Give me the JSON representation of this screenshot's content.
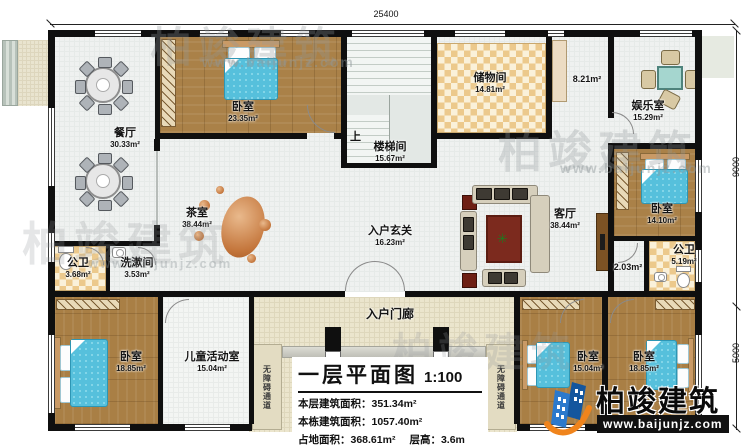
{
  "drawing": {
    "dimensions": {
      "top": "25400",
      "right_upper": "9000",
      "right_lower": "5000"
    },
    "rooms": [
      {
        "name": "餐厅",
        "area": "30.33m²"
      },
      {
        "name": "卧室",
        "area": "23.35m²"
      },
      {
        "name": "楼梯间",
        "area": "15.67m²",
        "up": "上"
      },
      {
        "name": "储物间",
        "area": "14.81m²"
      },
      {
        "name": "",
        "area": "8.21m²"
      },
      {
        "name": "娱乐室",
        "area": "15.29m²"
      },
      {
        "name": "茶室",
        "area": "38.44m²"
      },
      {
        "name": "入户玄关",
        "area": "16.23m²"
      },
      {
        "name": "客厅",
        "area": "38.44m²"
      },
      {
        "name": "卧室",
        "area": "14.10m²"
      },
      {
        "name": "公卫",
        "area": "5.19m²"
      },
      {
        "name": "",
        "area": "2.03m²"
      },
      {
        "name": "公卫",
        "area": "3.68m²"
      },
      {
        "name": "洗漱间",
        "area": "3.53m²"
      },
      {
        "name": "卧室",
        "area": "18.85m²"
      },
      {
        "name": "儿童活动室",
        "area": "15.04m²"
      },
      {
        "name": "卧室",
        "area": "15.04m²"
      },
      {
        "name": "卧室",
        "area": "18.85m²"
      },
      {
        "name": "入户门廊"
      },
      {
        "name": "无障碍通道"
      }
    ],
    "title_block": {
      "title": "一层平面图",
      "scale": "1:100",
      "rows": [
        {
          "label": "本层建筑面积：",
          "value": "351.34m²"
        },
        {
          "label": "本栋建筑面积：",
          "value": "1057.40m²"
        },
        {
          "label": "占地面积：",
          "value": "368.61m²"
        },
        {
          "label": "层高：",
          "value": "3.6m"
        }
      ]
    },
    "brand": {
      "name": "柏竣建筑",
      "url": "www.baijunjz.com"
    }
  }
}
